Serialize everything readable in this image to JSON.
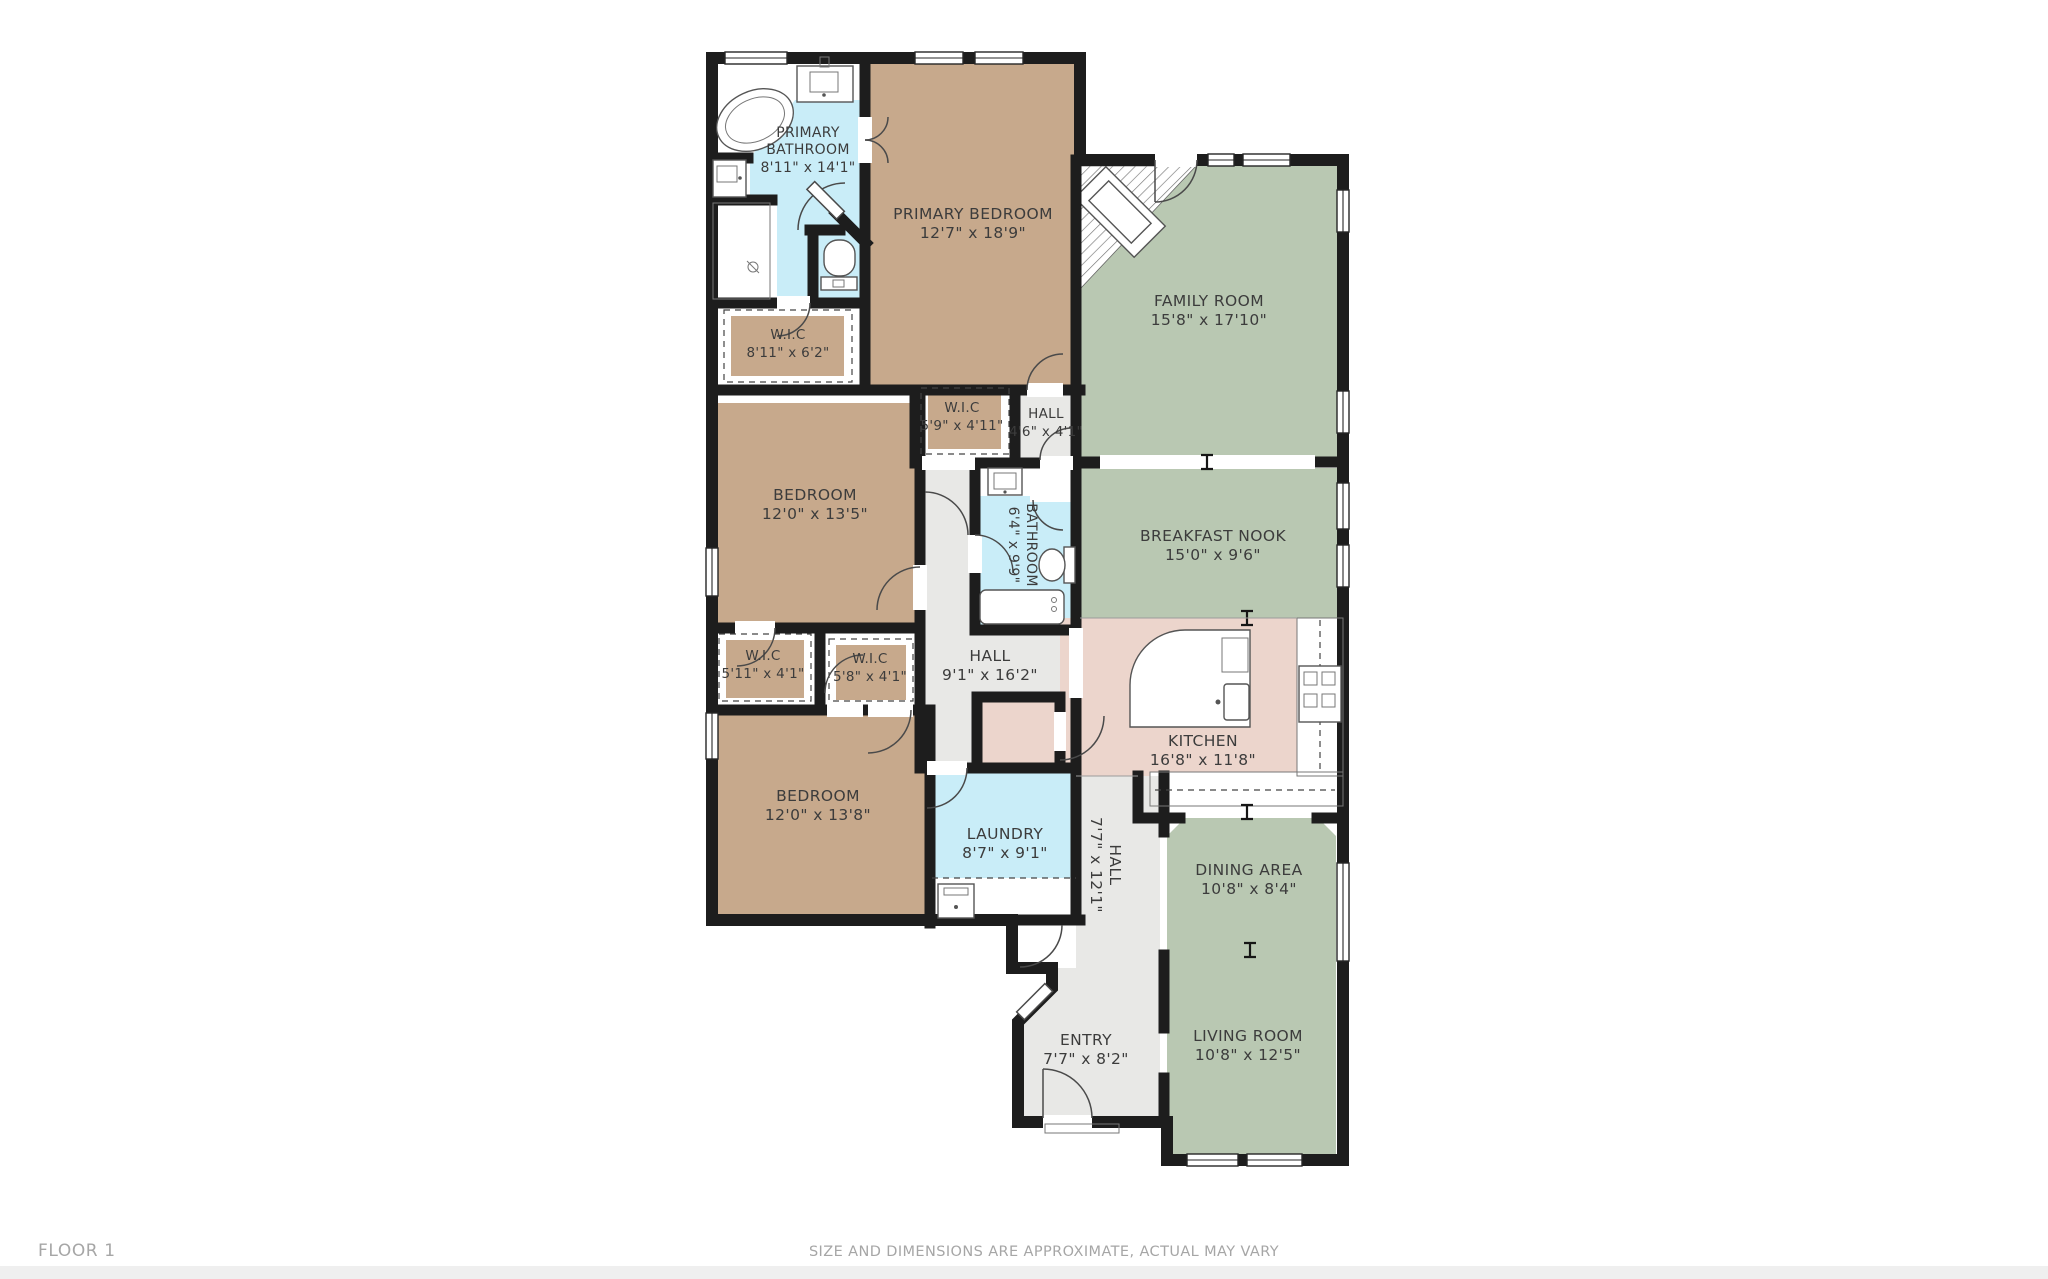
{
  "floor_label": "FLOOR 1",
  "disclaimer": "SIZE AND DIMENSIONS ARE APPROXIMATE, ACTUAL MAY VARY",
  "colors": {
    "wall": "#1d1d1d",
    "tan": "#c7a98c",
    "green": "#b9c8b2",
    "blue": "#c9edf8",
    "pink": "#ecd5cc",
    "hall": "#e8e8e6",
    "label": "#3c3c3c",
    "muted": "#a6a6a6",
    "footer_bar": "#efefef"
  },
  "rooms": [
    {
      "id": "primary-bathroom",
      "lines": [
        "PRIMARY",
        "BATHROOM"
      ],
      "dims": "8'11\" x 14'1\""
    },
    {
      "id": "primary-bedroom",
      "lines": [
        "PRIMARY BEDROOM"
      ],
      "dims": "12'7\" x 18'9\""
    },
    {
      "id": "family-room",
      "lines": [
        "FAMILY ROOM"
      ],
      "dims": "15'8\" x 17'10\""
    },
    {
      "id": "wic-primary",
      "lines": [
        "W.I.C"
      ],
      "dims": "8'11\" x 6'2\""
    },
    {
      "id": "wic-hall",
      "lines": [
        "W.I.C"
      ],
      "dims": "5'9\" x 4'11\""
    },
    {
      "id": "hall-upper",
      "lines": [
        "HALL"
      ],
      "dims": "4'6\" x 4'1\""
    },
    {
      "id": "bedroom-middle",
      "lines": [
        "BEDROOM"
      ],
      "dims": "12'0\" x 13'5\""
    },
    {
      "id": "bathroom",
      "lines": [
        "BATHROOM"
      ],
      "dims": "6'4\" x 9'9\""
    },
    {
      "id": "breakfast-nook",
      "lines": [
        "BREAKFAST NOOK"
      ],
      "dims": "15'0\" x 9'6\""
    },
    {
      "id": "wic-left",
      "lines": [
        "W.I.C"
      ],
      "dims": "5'11\" x 4'1\""
    },
    {
      "id": "wic-right",
      "lines": [
        "W.I.C"
      ],
      "dims": "5'8\" x 4'1\""
    },
    {
      "id": "hall-main",
      "lines": [
        "HALL"
      ],
      "dims": "9'1\" x 16'2\""
    },
    {
      "id": "kitchen",
      "lines": [
        "KITCHEN"
      ],
      "dims": "16'8\" x 11'8\""
    },
    {
      "id": "bedroom-lower",
      "lines": [
        "BEDROOM"
      ],
      "dims": "12'0\" x 13'8\""
    },
    {
      "id": "laundry",
      "lines": [
        "LAUNDRY"
      ],
      "dims": "8'7\" x 9'1\""
    },
    {
      "id": "hall-entry",
      "lines": [
        "HALL"
      ],
      "dims": "7'7\" x 12'1\""
    },
    {
      "id": "dining-area",
      "lines": [
        "DINING AREA"
      ],
      "dims": "10'8\" x 8'4\""
    },
    {
      "id": "entry",
      "lines": [
        "ENTRY"
      ],
      "dims": "7'7\" x 8'2\""
    },
    {
      "id": "living-room",
      "lines": [
        "LIVING ROOM"
      ],
      "dims": "10'8\" x 12'5\""
    }
  ]
}
